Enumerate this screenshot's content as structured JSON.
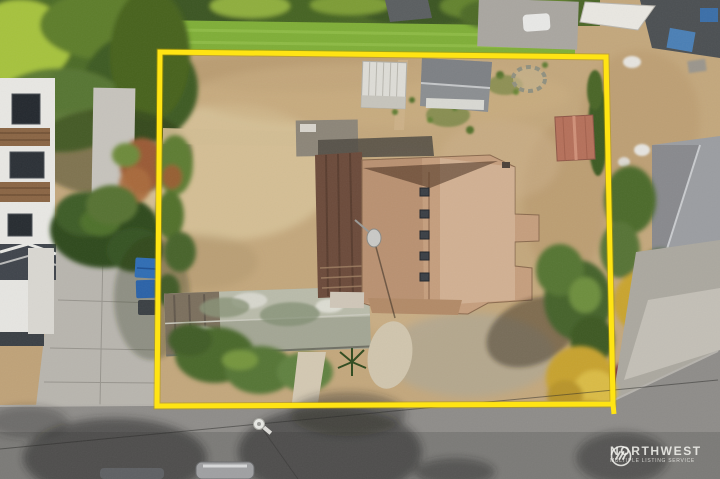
{
  "image": {
    "kind": "aerial-drone-photo",
    "subject": "top-down view of a residential lot outlined with a yellow property boundary; single-family house with tan shingle roof, detached mossy garage, three sheds, dry lawn, street with parked cars below, neighboring homes left and right"
  },
  "watermark": {
    "brand": "NORTHWEST",
    "tagline": "MULTIPLE LISTING SERVICE",
    "logo": "mountain-stripes-roundel-icon",
    "text_color": "#f5f4f0"
  },
  "boundary": {
    "label": "property-line-overlay",
    "color": "#ffe413",
    "corners": [
      [
        160,
        52
      ],
      [
        606,
        57
      ],
      [
        613,
        404
      ],
      [
        157,
        406
      ]
    ]
  },
  "palette": {
    "boundary_yellow": "#ffe413",
    "dry_grass_tan": "#c3a77c",
    "pale_dirt": "#d8c49a",
    "lawn_green": "#7fae37",
    "tree_dark_green": "#3c5a20",
    "roof_tan": "#c59e7d",
    "deck_brown": "#6b4a3a",
    "garage_moss_gray": "#a3a694",
    "rusty_shed": "#b5705a",
    "street_gray": "#8e8c89",
    "concrete": "#b8b5ae",
    "trash_bin_blue": "#2f6db4",
    "gold_tree": "#c7a22e",
    "white_structure": "#e8e7e3"
  },
  "scene": {
    "features": [
      "main-house-roof",
      "roof-skylights",
      "roof-deck",
      "detached-garage",
      "white-shed",
      "gray-shed",
      "rusty-shed",
      "stone-fire-pit",
      "back-lawn",
      "hedge-row",
      "left-neighbor-house",
      "right-neighbor-house",
      "right-neighbor-yard",
      "concrete-driveway",
      "trash-bins",
      "conifer-tree",
      "gold-tree",
      "street",
      "street-tree-shadows",
      "utility-pole",
      "power-lines",
      "parked-cars",
      "yard-lamp",
      "dirt-paths"
    ]
  }
}
